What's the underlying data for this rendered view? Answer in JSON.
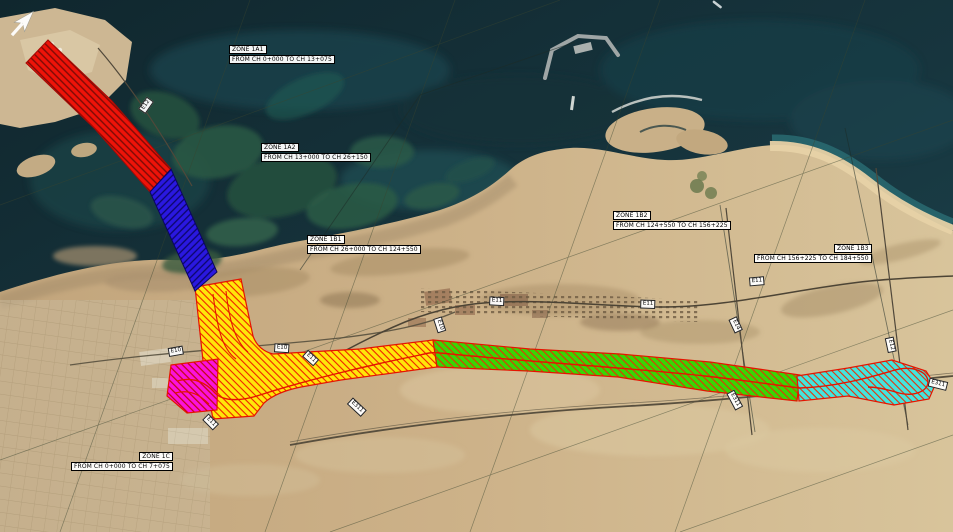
{
  "zones": {
    "z1a1": {
      "label": "ZONE 1A1",
      "range": "FROM CH 0+000 TO CH 13+075",
      "color": "#ee1309",
      "hatch": "#7c0b06"
    },
    "z1a2": {
      "label": "ZONE 1A2",
      "range": "FROM CH 13+000 TO CH 26+150",
      "color": "#2a18e0",
      "hatch": "#0c0668"
    },
    "z1b1": {
      "label": "ZONE 1B1",
      "range": "FROM CH 26+000 TO CH 124+550",
      "color": "#ffe60a",
      "hatch": "#f02000"
    },
    "z1b2": {
      "label": "ZONE 1B2",
      "range": "FROM CH 124+550 TO CH 156+225",
      "color": "#37d704",
      "hatch": "#e73008"
    },
    "z1b3": {
      "label": "ZONE 1B3",
      "range": "FROM CH 156+225 TO CH 184+550",
      "color": "#43e5de",
      "hatch": "#e73008"
    },
    "z1c": {
      "label": "ZONE 1C",
      "range": "FROM CH 0+000 TO CH 7+075",
      "color": "#fb12dd",
      "hatch": "#c00808"
    }
  },
  "roads": {
    "e10": "E10",
    "e11": "E11",
    "e12": "E12",
    "e14": "E14",
    "e311": "E311"
  },
  "icons": {
    "north_arrow": "compass-north-arrow",
    "boat_wake": "boat-wake"
  },
  "colors": {
    "sea": "#16333b",
    "land": "#c9ad85",
    "mangrove": "#23503f",
    "alignment_line": "#e51400",
    "label_bg": "#ffffff",
    "label_text": "#000000"
  }
}
